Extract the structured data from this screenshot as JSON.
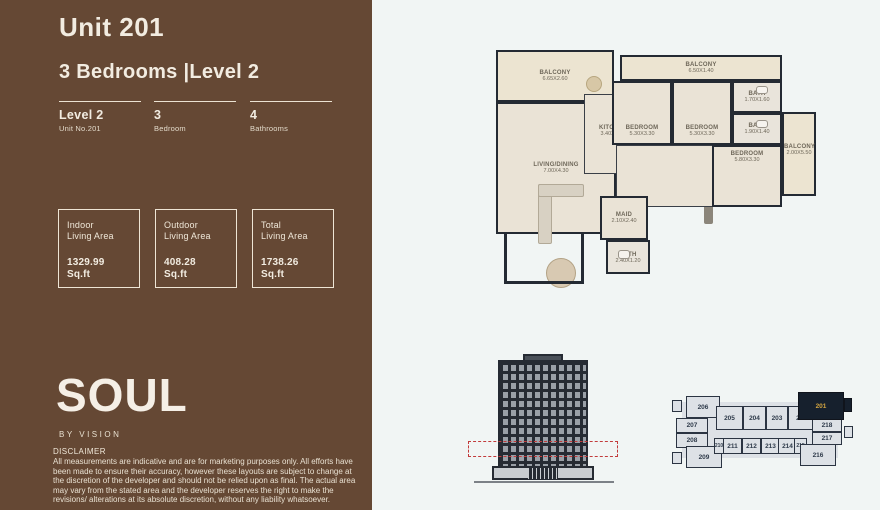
{
  "page": {
    "title": "Unit 201",
    "subtitle": "3 Bedrooms |Level 2"
  },
  "specs": [
    {
      "value": "Level 2",
      "label": "Unit No.201"
    },
    {
      "value": "3",
      "label": "Bedroom"
    },
    {
      "value": "4",
      "label": "Bathrooms"
    }
  ],
  "areas": [
    {
      "label_line1": "Indoor",
      "label_line2": "Living Area",
      "value": "1329.99",
      "unit": "Sq.ft"
    },
    {
      "label_line1": "Outdoor",
      "label_line2": "Living Area",
      "value": "408.28",
      "unit": "Sq.ft"
    },
    {
      "label_line1": "Total",
      "label_line2": "Living Area",
      "value": "1738.26",
      "unit": "Sq.ft"
    }
  ],
  "brand": {
    "logo": "SOUL",
    "tagline": "BY VISION"
  },
  "disclaimer": {
    "title": "DISCLAIMER",
    "text": "All measurements are indicative and are for marketing purposes only. All efforts have been made to ensure their accuracy, however these layouts are subject to change at the discretion of the developer and should not be relied upon as final. The actual area may vary from the stated area and the developer reserves the right to make the revisions/ alterations at its absolute discretion, without any liability whatsoever."
  },
  "floor_plan": {
    "rooms": [
      {
        "name": "BALCONY",
        "dims": "6.65X2.60"
      },
      {
        "name": "BALCONY",
        "dims": "6.50X1.40"
      },
      {
        "name": "BEDROOM",
        "dims": "5.30X3.30"
      },
      {
        "name": "BEDROOM",
        "dims": "5.30X3.30"
      },
      {
        "name": "BATH",
        "dims": "1.70X1.60"
      },
      {
        "name": "BATH",
        "dims": "1.90X1.40"
      },
      {
        "name": "BEDROOM",
        "dims": "5.80X3.30"
      },
      {
        "name": "BALCONY",
        "dims": "2.00X5.50"
      },
      {
        "name": "KITCHEN",
        "dims": "3.40X4.05"
      },
      {
        "name": "LIVING/DINING",
        "dims": "7.00X4.30"
      },
      {
        "name": "MAID",
        "dims": "2.10X2.40"
      },
      {
        "name": "BATH",
        "dims": "2.40X1.20"
      }
    ]
  },
  "key_plan": {
    "highlighted_unit": "201",
    "units": [
      "206",
      "205",
      "204",
      "203",
      "202",
      "201",
      "207",
      "208",
      "209",
      "210",
      "211",
      "212",
      "213",
      "214",
      "215",
      "216",
      "217",
      "218"
    ]
  },
  "colors": {
    "sidebar_brown": "#654834",
    "cream_text": "#f2ece1",
    "panel_background": "#f1f5f4",
    "plan_wall": "#242a33",
    "plan_floor": "#eae3d6",
    "highlight_navy": "#16202d",
    "highlight_gold": "#d2a440",
    "level_marker_red": "#c23b3b"
  }
}
